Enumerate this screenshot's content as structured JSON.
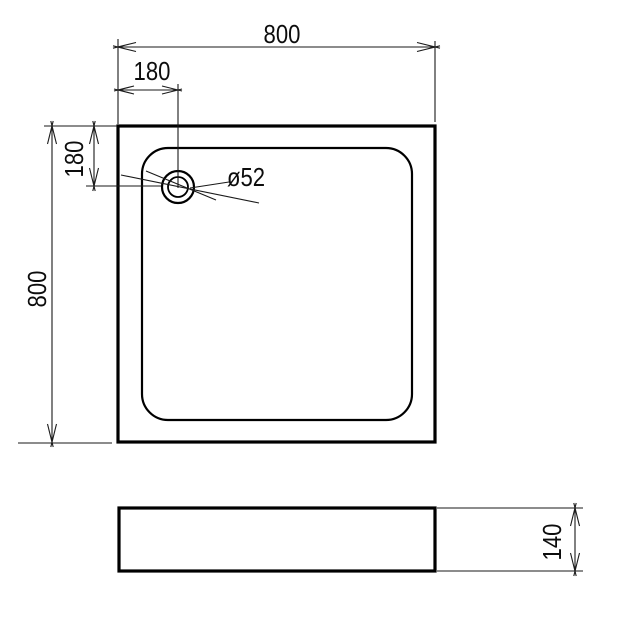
{
  "drawing": {
    "background_color": "#ffffff",
    "line_color": "#000000",
    "views": {
      "top_view": {
        "dimensions": {
          "overall_width": "800",
          "drain_offset_horizontal": "180",
          "overall_height": "800",
          "drain_offset_vertical": "180",
          "drain_diameter": "ø52"
        }
      },
      "side_view": {
        "dimensions": {
          "overall_height": "140"
        }
      }
    }
  }
}
